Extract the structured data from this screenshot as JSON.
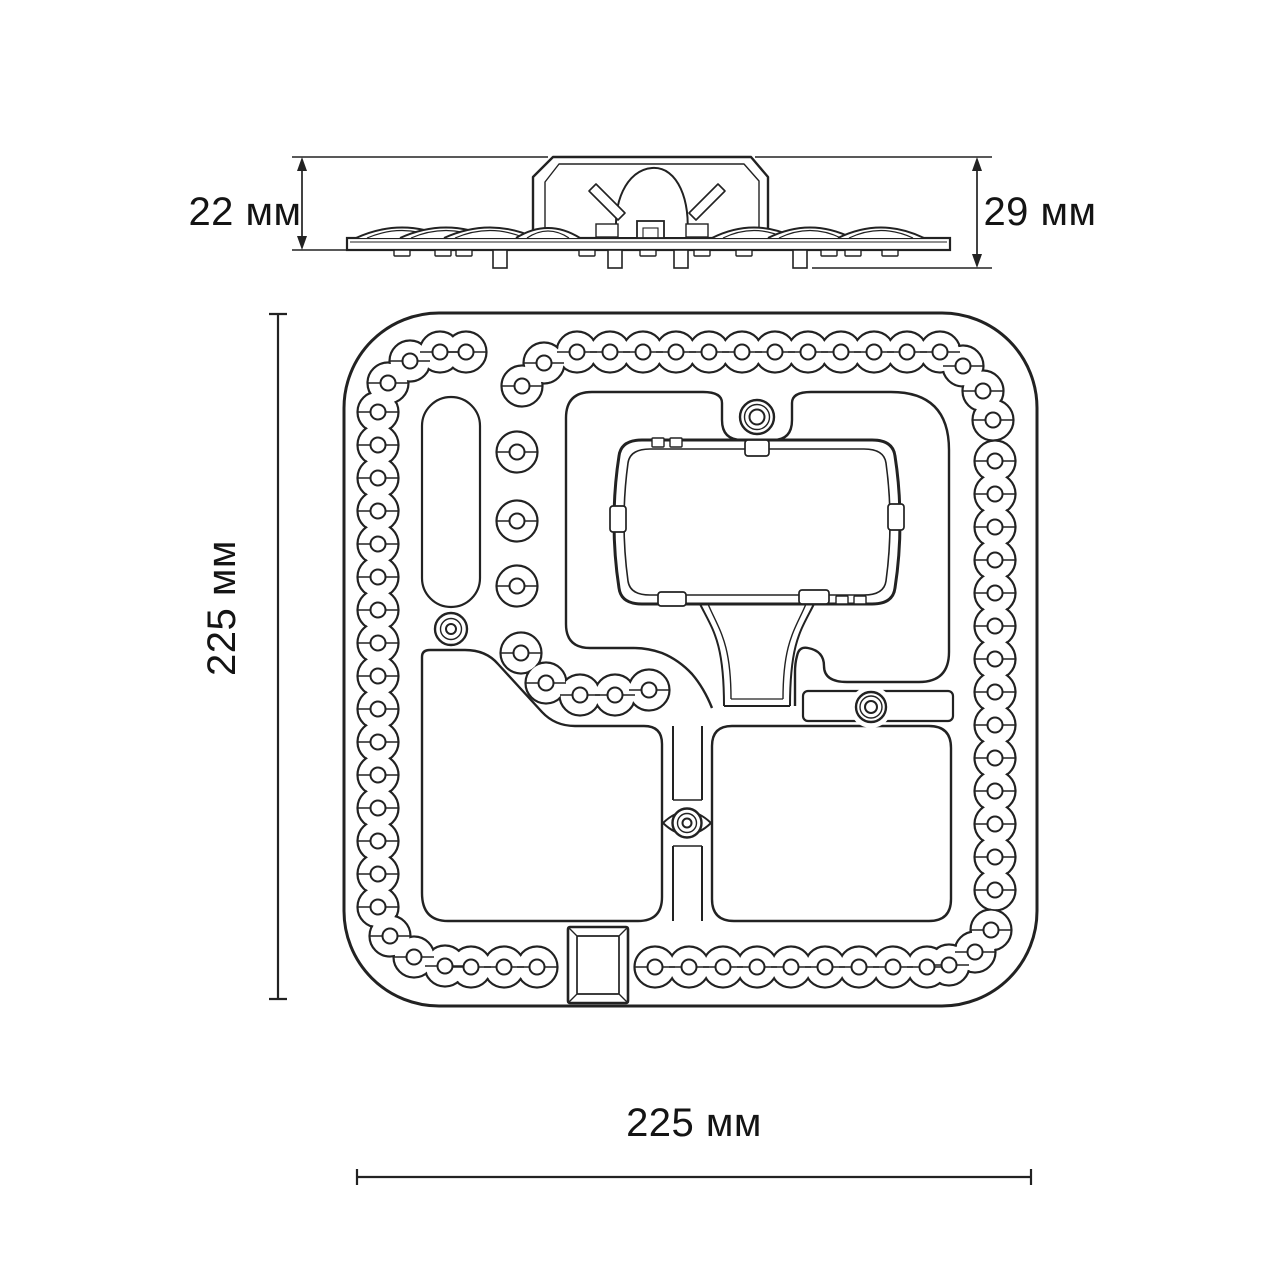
{
  "meta": {
    "type": "technical-dimensional-drawing",
    "subject": "LED ceiling light module (side view and top view)"
  },
  "labels": {
    "side_left": "22 мм",
    "side_right": "29 мм",
    "top_left": "225 мм",
    "top_bottom": "225 мм"
  },
  "colors": {
    "line": "#222222",
    "text": "#141414",
    "background": "#ffffff"
  },
  "drawing": {
    "led": {
      "outer_r": 20.5,
      "fill_r": 19.2,
      "inner_r": 7.5
    },
    "led_points": {
      "left_column": [
        [
          378,
          412
        ],
        [
          378,
          445
        ],
        [
          378,
          478
        ],
        [
          378,
          511
        ],
        [
          378,
          544
        ],
        [
          378,
          577
        ],
        [
          378,
          610
        ],
        [
          378,
          643
        ],
        [
          378,
          676
        ],
        [
          378,
          709
        ],
        [
          378,
          742
        ],
        [
          378,
          775
        ],
        [
          378,
          808
        ],
        [
          378,
          841
        ],
        [
          378,
          874
        ],
        [
          378,
          907
        ]
      ],
      "corner_top_left": [
        [
          388,
          383
        ],
        [
          410,
          361
        ],
        [
          440,
          352
        ],
        [
          466,
          352
        ]
      ],
      "top_row": [
        [
          577,
          352
        ],
        [
          610,
          352
        ],
        [
          643,
          352
        ],
        [
          676,
          352
        ],
        [
          709,
          352
        ],
        [
          742,
          352
        ],
        [
          775,
          352
        ],
        [
          808,
          352
        ],
        [
          841,
          352
        ],
        [
          874,
          352
        ],
        [
          907,
          352
        ],
        [
          940,
          352
        ]
      ],
      "corner_top_right": [
        [
          963,
          366
        ],
        [
          983,
          391
        ],
        [
          993,
          420
        ]
      ],
      "right_column": [
        [
          995,
          461
        ],
        [
          995,
          494
        ],
        [
          995,
          527
        ],
        [
          995,
          560
        ],
        [
          995,
          593
        ],
        [
          995,
          626
        ],
        [
          995,
          659
        ],
        [
          995,
          692
        ],
        [
          995,
          725
        ],
        [
          995,
          758
        ],
        [
          995,
          791
        ],
        [
          995,
          824
        ],
        [
          995,
          857
        ],
        [
          995,
          890
        ]
      ],
      "corner_bottom_right": [
        [
          991,
          930
        ],
        [
          975,
          952
        ],
        [
          949,
          965
        ]
      ],
      "bottom_row_right": [
        [
          927,
          967
        ],
        [
          893,
          967
        ],
        [
          859,
          967
        ],
        [
          825,
          967
        ],
        [
          791,
          967
        ],
        [
          757,
          967
        ],
        [
          723,
          967
        ],
        [
          689,
          967
        ],
        [
          655,
          967
        ]
      ],
      "bottom_row_left": [
        [
          537,
          967
        ],
        [
          504,
          967
        ],
        [
          471,
          967
        ]
      ],
      "corner_bottom_left": [
        [
          445,
          966
        ],
        [
          414,
          957
        ],
        [
          390,
          936
        ]
      ],
      "top_branch": [
        [
          544,
          363
        ],
        [
          522,
          386
        ]
      ],
      "inner_singles": [
        [
          517,
          452
        ],
        [
          517,
          521
        ],
        [
          517,
          586
        ]
      ],
      "inner_chain": [
        [
          521,
          653
        ],
        [
          546,
          683
        ],
        [
          580,
          695
        ],
        [
          615,
          695
        ],
        [
          649,
          690
        ]
      ]
    },
    "screws": [
      {
        "name": "screw-top-center",
        "x": 757,
        "y": 417,
        "rings": [
          17,
          12.5,
          7.5
        ]
      },
      {
        "name": "screw-left",
        "x": 451,
        "y": 629,
        "rings": [
          16,
          10.5,
          5
        ]
      },
      {
        "name": "screw-right",
        "x": 871,
        "y": 707,
        "rings": [
          15,
          11,
          6
        ]
      },
      {
        "name": "screw-bottom",
        "x": 687,
        "y": 823,
        "rings": [
          14.5,
          9.5,
          4.5
        ]
      }
    ]
  }
}
